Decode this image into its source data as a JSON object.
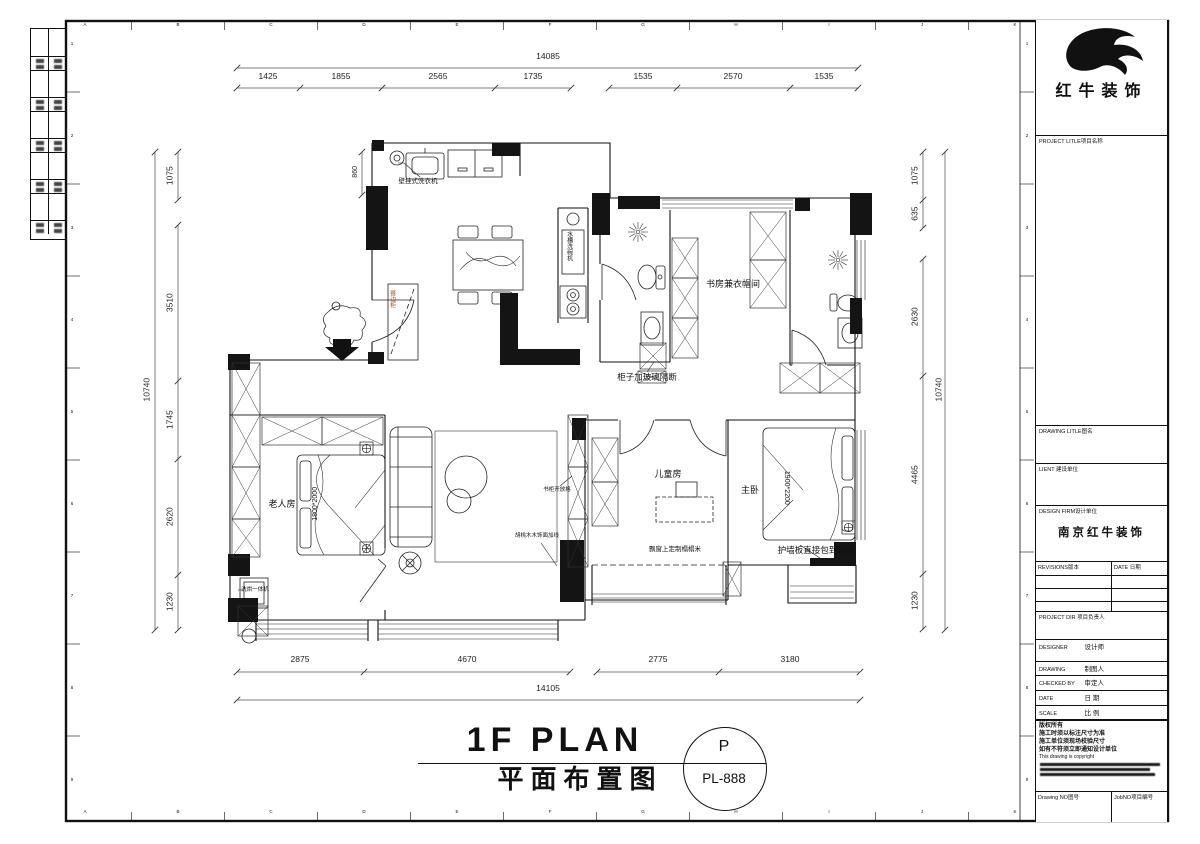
{
  "sheet": {
    "grid_letters": [
      "A",
      "B",
      "C",
      "D",
      "E",
      "F",
      "G",
      "H",
      "I",
      "J",
      "K"
    ],
    "grid_numbers": [
      "1",
      "2",
      "3",
      "4",
      "5",
      "6",
      "7",
      "8",
      "9"
    ]
  },
  "titleblock": {
    "brand": "红牛装饰",
    "project_label": "PROJECT LITLE项目名称",
    "drawing_title_label": "DRAWING LITLE图名",
    "client_label": "LIENT 建设单位",
    "design_firm_label": "DESIGN FIRM设计单位",
    "design_firm_value": "南京红牛装饰",
    "revisions_label": "REVISIONS版本",
    "revision_date_label": "DATE 日期",
    "project_dir_label": "PROJECT DIR 项目负责人",
    "designer_en": "DESIGNER",
    "designer_cn": "设计师",
    "drawing_by_en": "DRAWING",
    "drawing_by_cn": "制图人",
    "checked_en": "CHECKED BY",
    "checked_cn": "审定人",
    "date_en": "DATE",
    "date_cn": "日 期",
    "scale_en": "SCALE",
    "scale_cn": "比 例",
    "copyright_lines": [
      "版权所有",
      "施工时须以标注尺寸为准",
      "施工单位须现场校验尺寸",
      "如有不符须立即通知设计单位",
      "This drawing is copyright"
    ],
    "drawing_no_label": "Drawing NO图号",
    "job_no_label": "JobNO项目编号"
  },
  "footer": {
    "title_en": "1F PLAN",
    "title_cn": "平面布置图",
    "sheet_letter": "P",
    "sheet_code": "PL-888"
  },
  "dims": {
    "top": {
      "total": "14085",
      "segments": [
        "1425",
        "1855",
        "2565",
        "1735",
        "1535",
        "2570",
        "1535"
      ]
    },
    "bottom": {
      "total": "14105",
      "segments": [
        "2875",
        "4670",
        "2775",
        "3180"
      ]
    },
    "left": {
      "total": "10740",
      "segments": [
        "1075",
        "3510",
        "1745",
        "2620",
        "1230"
      ]
    },
    "right": {
      "total": "10740",
      "segments": [
        "1075",
        "635",
        "2630",
        "4465",
        "1230"
      ]
    },
    "balcony_height": "860"
  },
  "rooms": {
    "elder": "老人房",
    "child": "儿童房",
    "master": "主卧",
    "study": "书房兼衣帽间"
  },
  "annotations": {
    "washer_wall": "壁挂式洗衣机",
    "cabinet_glass": "柜子加玻璃隔断",
    "tatami": "飘窗上定制榻榻米",
    "wall_panel": "护墙板直接包到飘窗",
    "bookcase": "书柜开放格",
    "walnut": "胡桃木木饰面加线",
    "washer_dryer": "洗烘一体机",
    "sink_dishwasher": "水槽洗碗机",
    "sideboard": "餐边柜",
    "bed_elder": "1800*2000",
    "bed_master": "1900*2200"
  }
}
